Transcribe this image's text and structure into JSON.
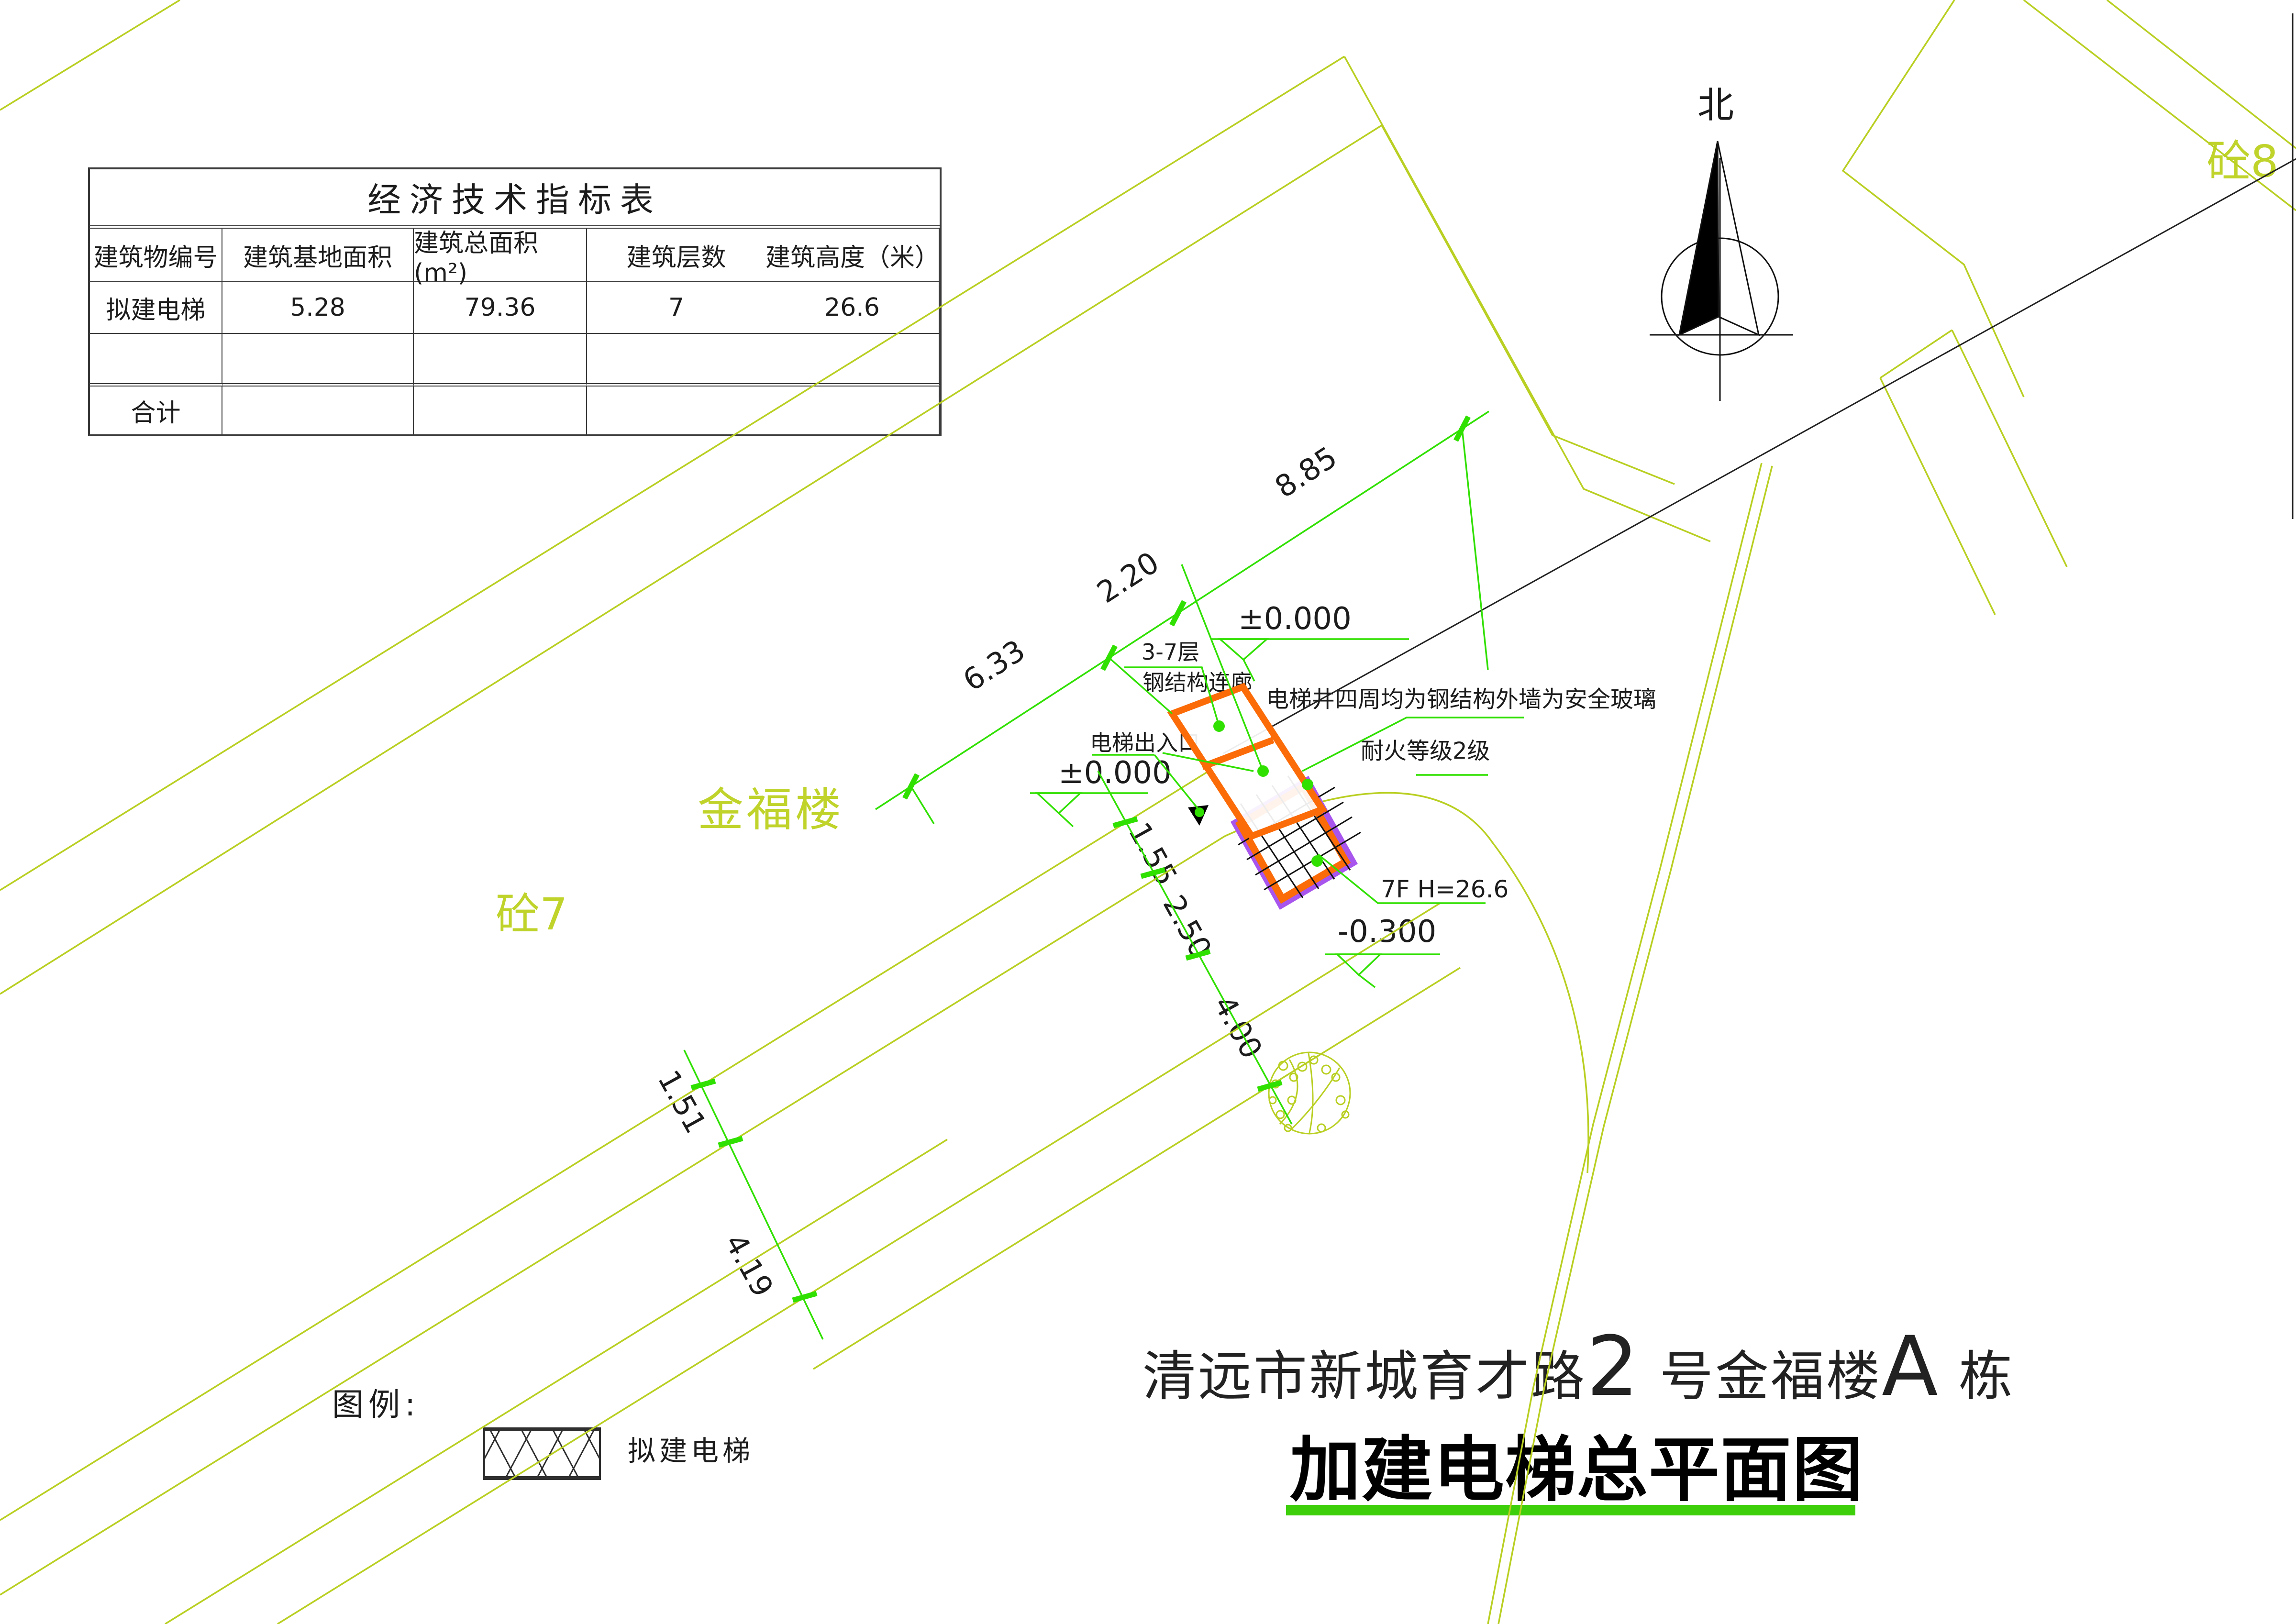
{
  "table": {
    "title": "经济技术指标表",
    "headers": [
      "建筑物编号",
      "建筑基地面积",
      "建筑总面积(m²)",
      "建筑层数",
      "建筑高度（米）"
    ],
    "rows": [
      [
        "拟建电梯",
        "5.28",
        "79.36",
        "7",
        "26.6"
      ],
      [
        "",
        "",
        "",
        "",
        ""
      ]
    ],
    "total_label": "合计",
    "total_values": [
      "",
      "",
      "",
      ""
    ]
  },
  "compass": {
    "label": "北"
  },
  "plan": {
    "buildings": {
      "main": "金福楼",
      "concrete7": "砼7",
      "concrete8": "砼8"
    },
    "annotations": {
      "floors": "3-7层",
      "corridor": "钢结构连廊",
      "entrance": "电梯出入口",
      "shaft_note_line1": "电梯井四周均为钢结构外墙为安全玻璃",
      "shaft_note_line2": "耐火等级2级",
      "height_note": "7F H=26.6"
    },
    "levels": {
      "ground_upper": "±0.000",
      "ground_entry": "±0.000",
      "road": "-0.300"
    },
    "dimensions": {
      "chain_top": [
        "6.33",
        "2.20",
        "8.85"
      ],
      "chain_side": [
        "1.55",
        "2.50",
        "4.00"
      ],
      "chain_road": [
        "1.51",
        "4.19"
      ]
    }
  },
  "legend": {
    "label": "图例:",
    "item_label": "拟建电梯"
  },
  "title_block": {
    "line1_parts": [
      "清远市新城育才路",
      "2",
      " 号金福楼",
      "A",
      " 栋"
    ],
    "line2": "加建电梯总平面图"
  },
  "colors": {
    "boundary_olive": "#b9cf22",
    "dimension_green": "#30e000",
    "underline_green": "#3ecf0b",
    "corridor_orange": "#fb6b07",
    "shaft_purple": "#a855ee"
  }
}
